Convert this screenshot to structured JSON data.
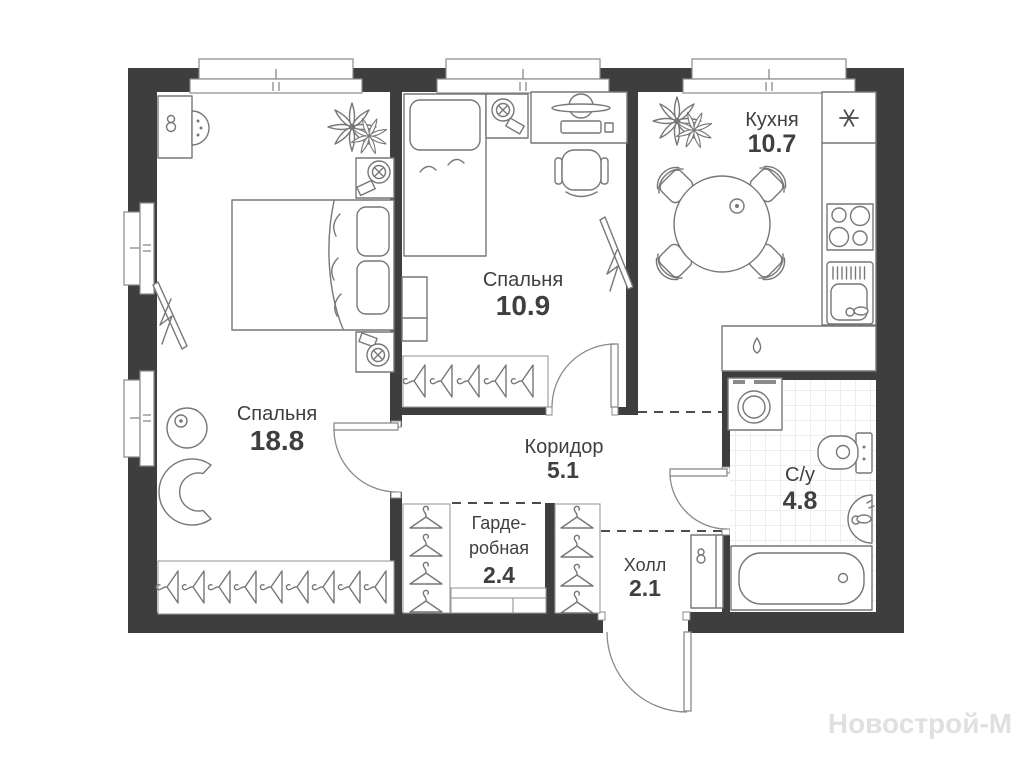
{
  "watermark": "Новострой-М",
  "rooms": {
    "bedroom_large": {
      "name": "Спальня",
      "area": "18.8"
    },
    "bedroom_small": {
      "name": "Спальня",
      "area": "10.9"
    },
    "kitchen": {
      "name": "Кухня",
      "area": "10.7"
    },
    "corridor": {
      "name": "Коридор",
      "area": "5.1"
    },
    "wardrobe": {
      "name_line1": "Гарде-",
      "name_line2": "робная",
      "area": "2.4"
    },
    "hall": {
      "name": "Холл",
      "area": "2.1"
    },
    "bathroom": {
      "name": "С/у",
      "area": "4.8"
    }
  },
  "icons": {
    "fridge_indicator": "snowflake",
    "water_point_indicator": "water-drop"
  },
  "colors": {
    "wall": "#3e3e3e",
    "furniture_line": "#777777",
    "label_text": "#3f3f3f",
    "tile_line": "#dcdcdc",
    "dashed_line": "#4c4c4c",
    "watermark": "#e0e0e0"
  }
}
